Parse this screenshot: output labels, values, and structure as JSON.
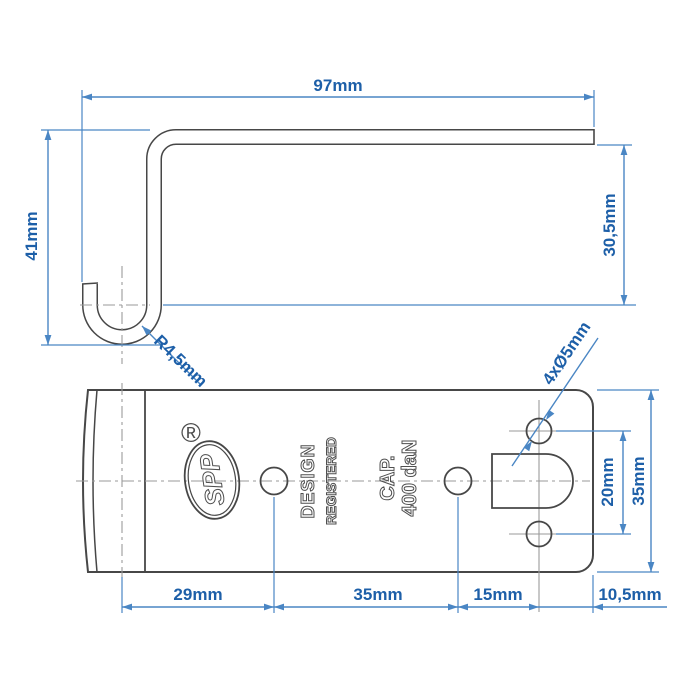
{
  "side_view": {
    "width": "97mm",
    "height": "41mm",
    "inner_height": "30,5mm",
    "hook_radius": "R4,5mm"
  },
  "plan_view": {
    "holes": "4xØ5mm",
    "hole_gap": "20mm",
    "plate_width": "35mm",
    "offset_1": "29mm",
    "offset_2": "35mm",
    "offset_3": "15mm",
    "offset_4": "10,5mm"
  },
  "markings": {
    "brand": "SPP",
    "registered": "®",
    "line1": "DESIGN",
    "line2": "REGISTERED",
    "cap": "CAP.",
    "capacity": "400 daN"
  },
  "colors": {
    "dimension_blue": "#4a86c4",
    "label_blue": "#1d5fa8",
    "outline_dark": "#474747",
    "centerline_gray": "#9a9a9a"
  }
}
